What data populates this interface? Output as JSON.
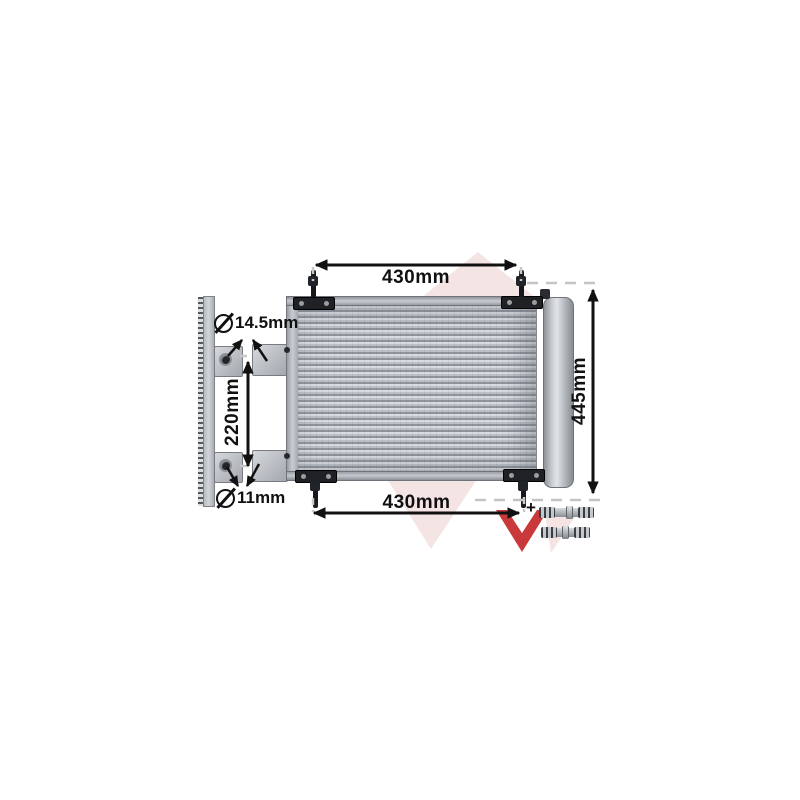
{
  "scene": {
    "title": "A/C condenser technical illustration with dimensions",
    "background": "#ffffff"
  },
  "dimensions": {
    "top_width": "430mm",
    "bottom_width": "430mm",
    "overall_height": "445mm",
    "bracket_spacing": "220mm",
    "upper_hole_diameter": "14.5mm",
    "lower_hole_diameter": "11mm"
  },
  "symbols": {
    "diameter": "⌀",
    "plus": "+"
  },
  "brand_watermark": {
    "name": "van-wezel-logo",
    "pink": "#f5e4e4",
    "red": "#c9393b"
  },
  "ink": "#111111"
}
